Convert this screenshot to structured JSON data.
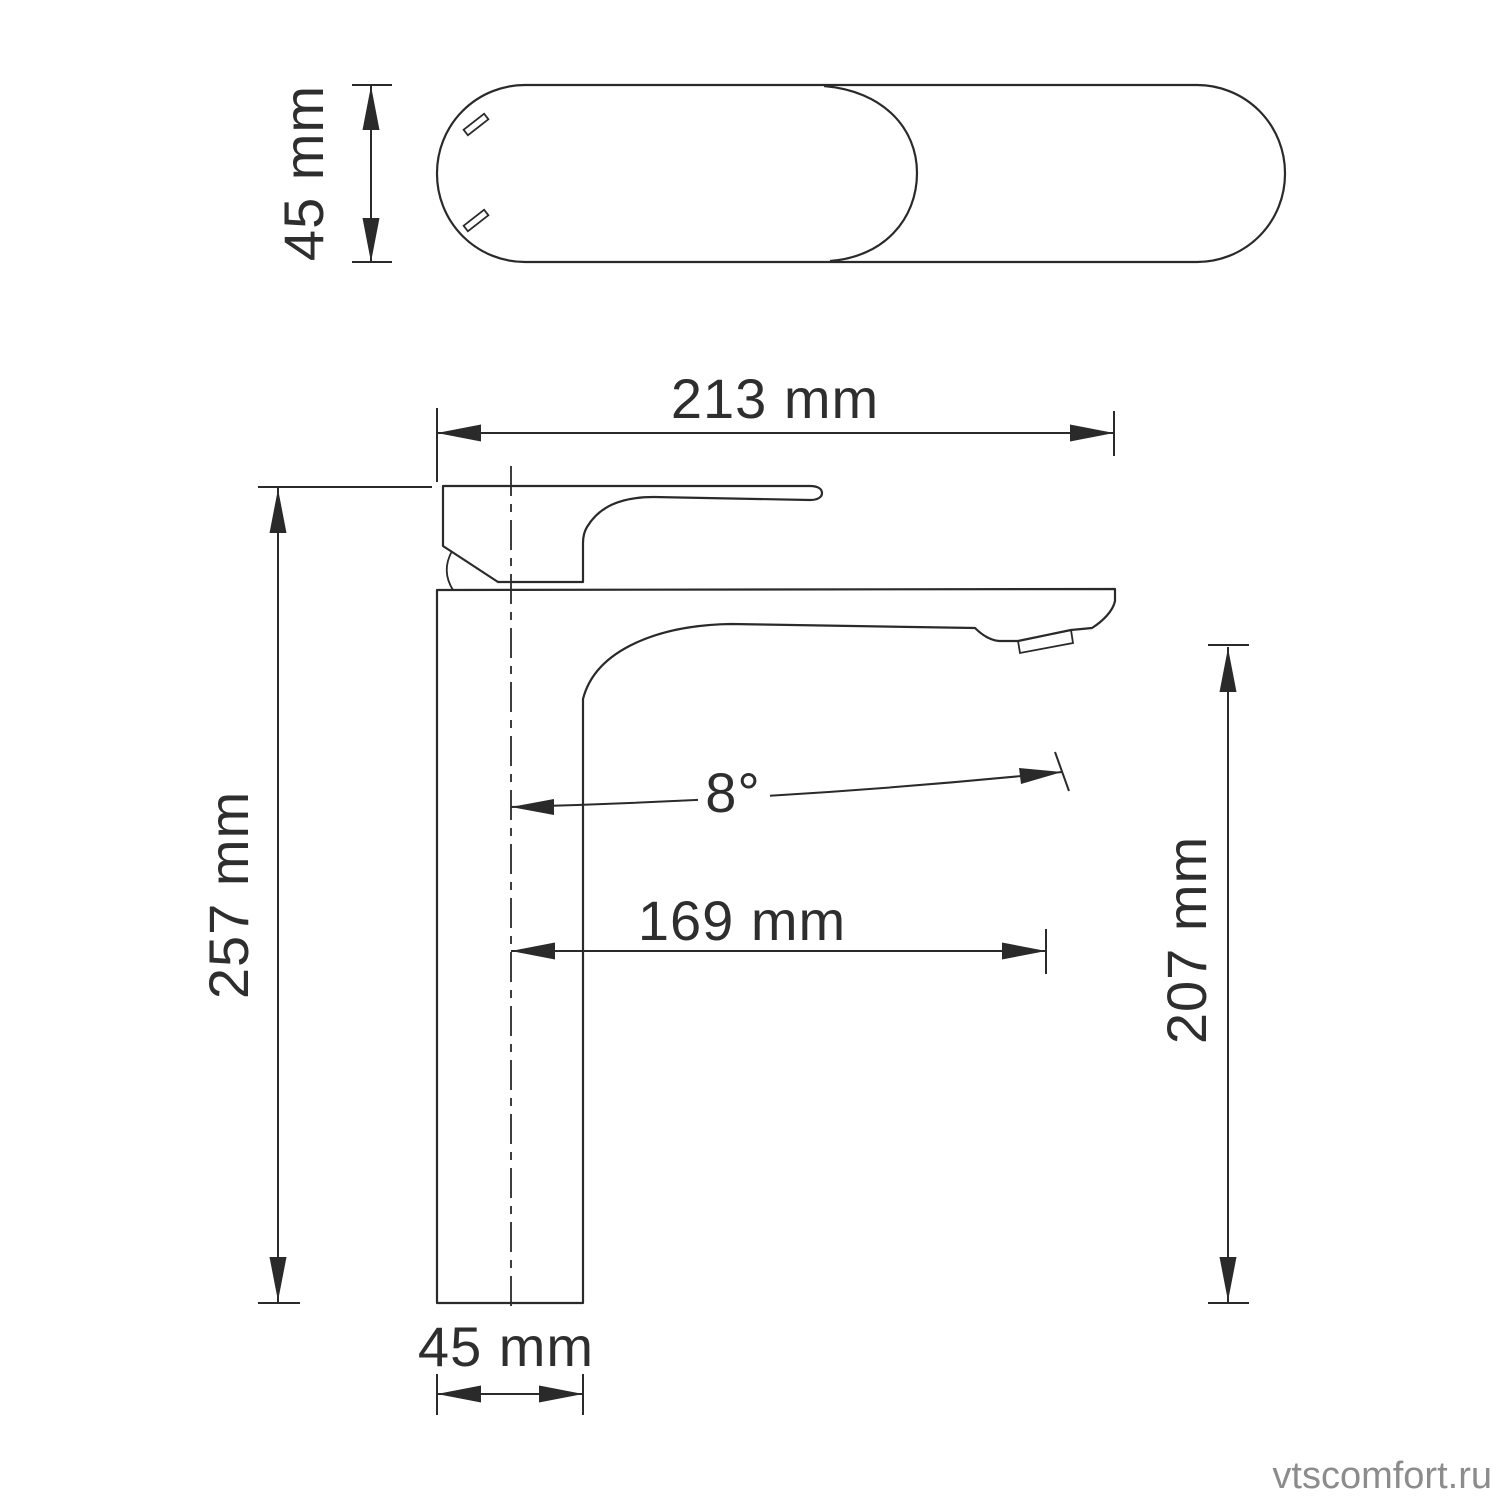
{
  "drawing": {
    "watermark": "vtscomfort.ru",
    "dimensions": {
      "top_view_height": "45 mm",
      "overall_length": "213 mm",
      "overall_height": "257 mm",
      "spout_angle": "8°",
      "spout_reach": "169 mm",
      "spout_outlet_height": "207 mm",
      "base_width": "45 mm"
    },
    "colors": {
      "line": "#2a2a2a",
      "text": "#2e2e2e",
      "watermark": "#8c8c8c",
      "background": "#ffffff"
    }
  }
}
